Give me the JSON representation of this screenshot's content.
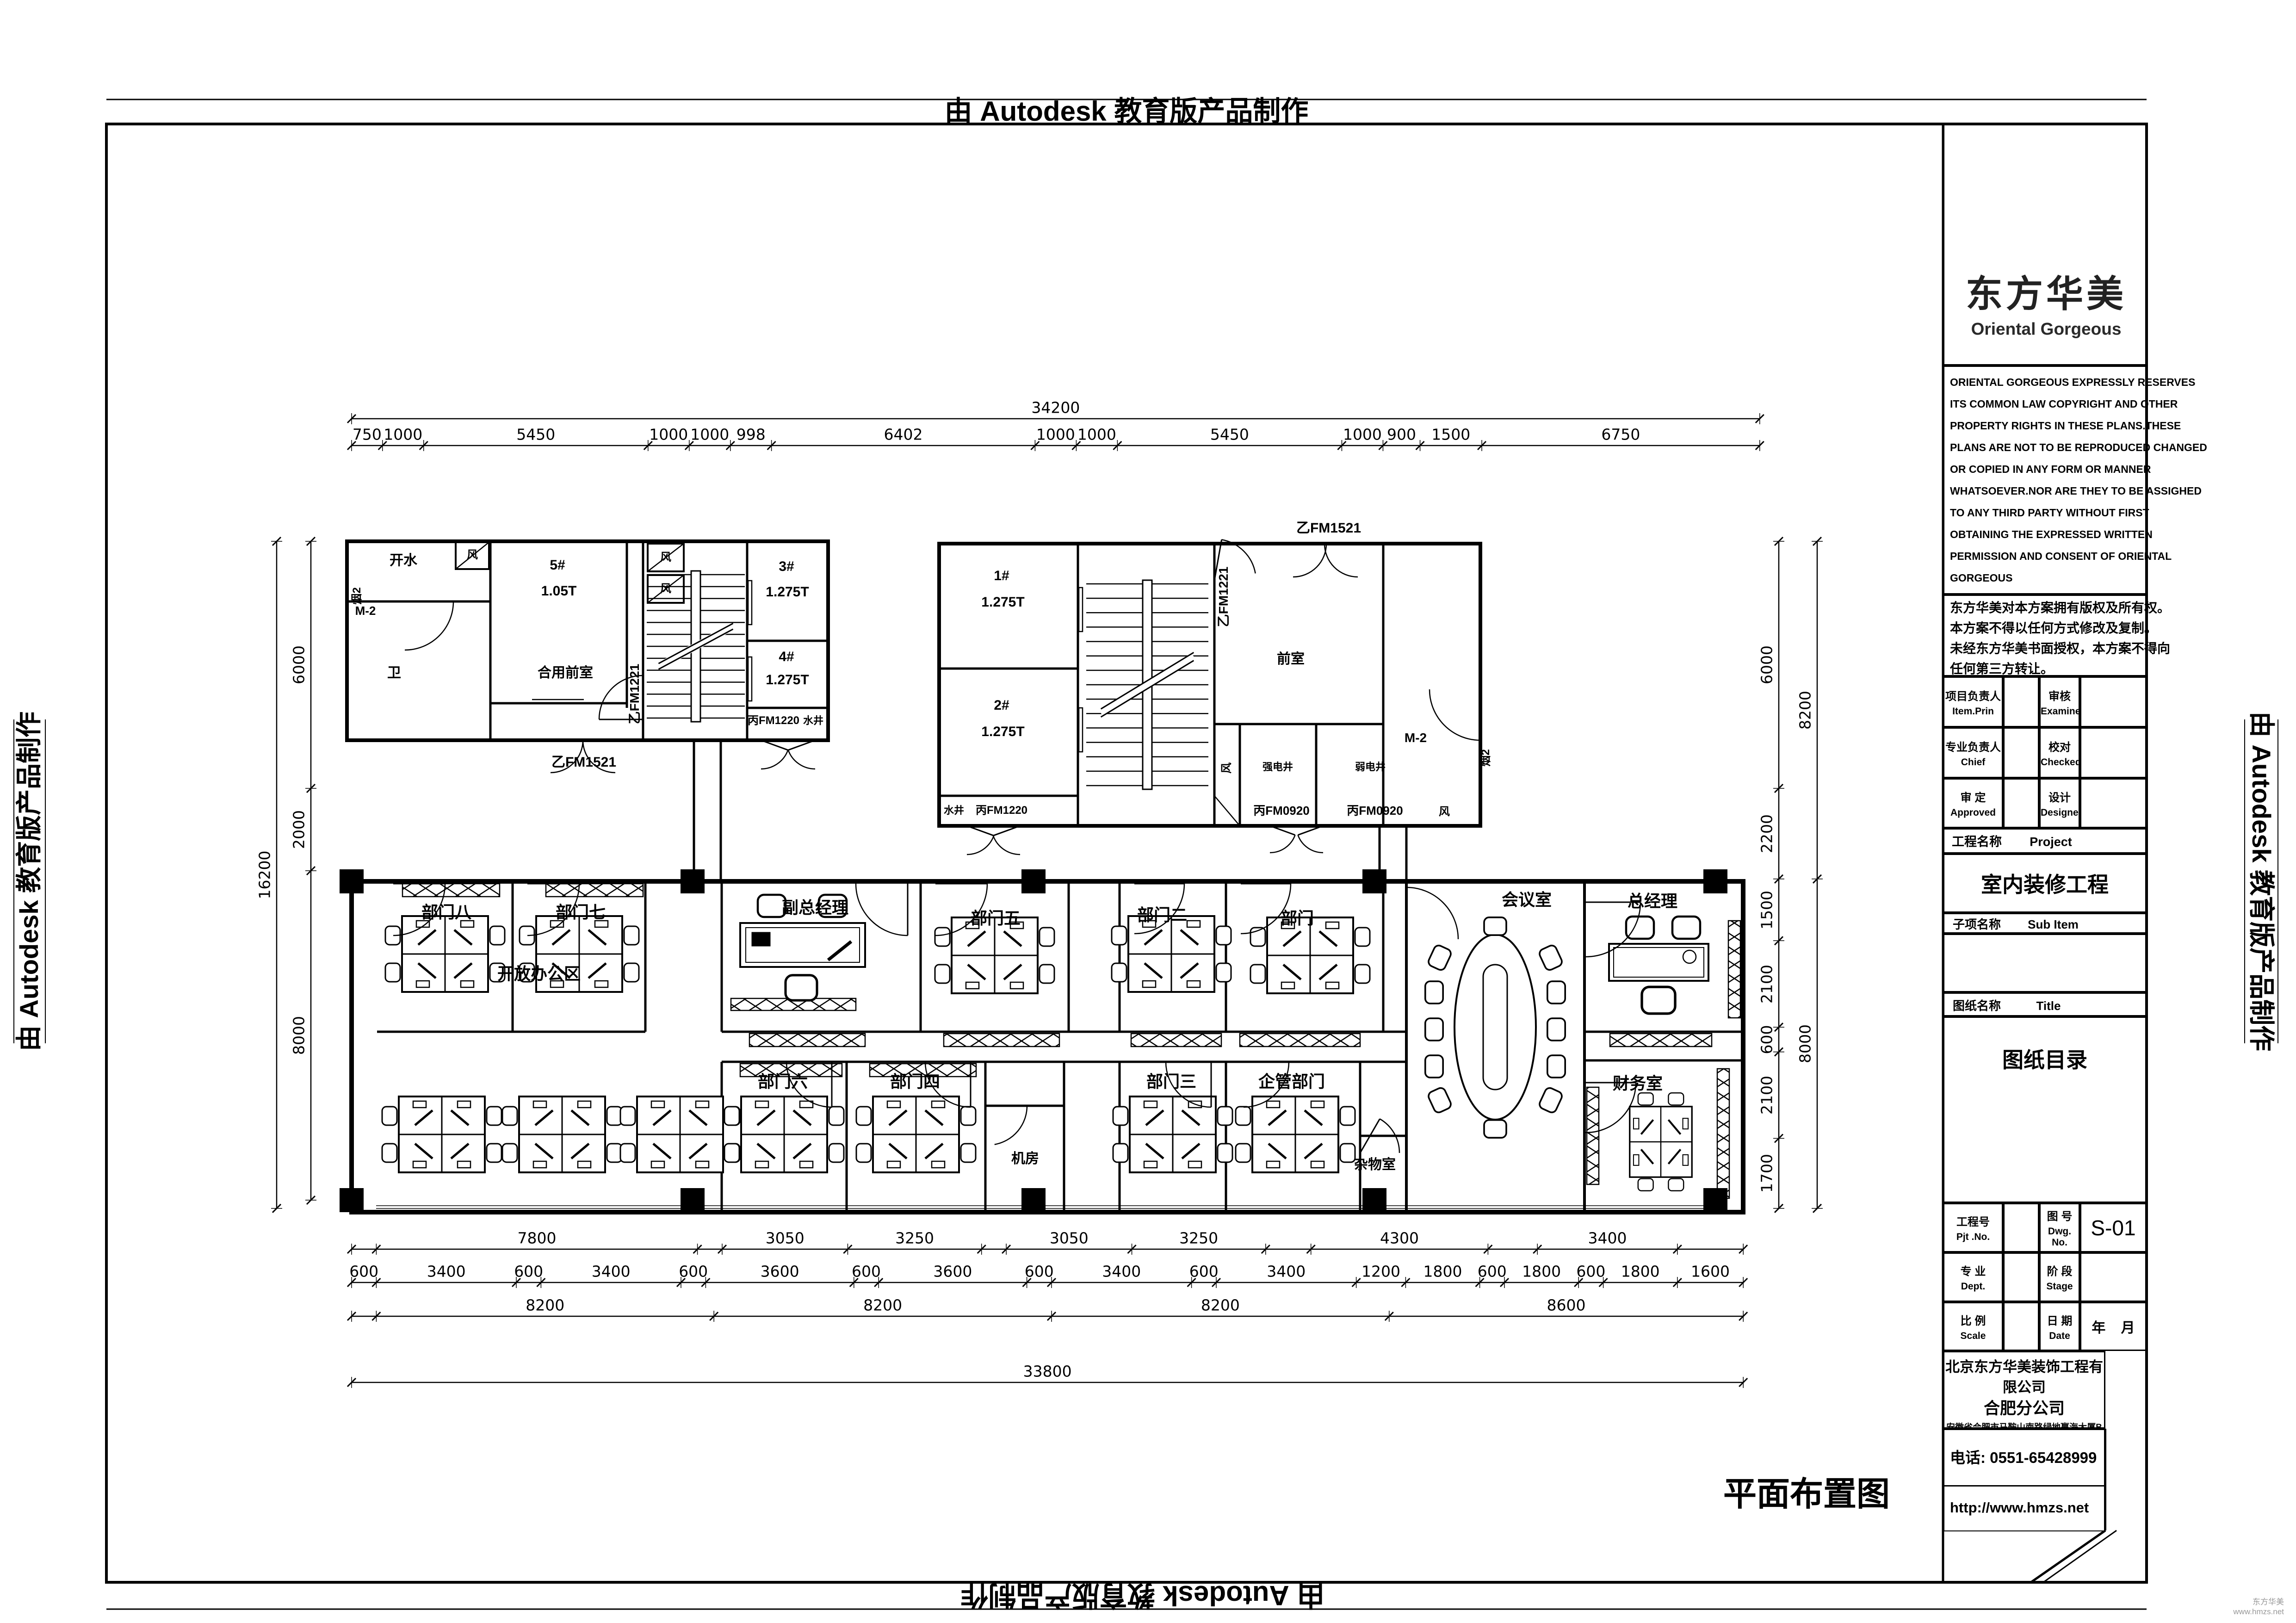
{
  "stamp": {
    "text": "由 Autodesk 教育版产品制作"
  },
  "sheet_title": "平面布置图",
  "watermark": {
    "line1": "东方华美",
    "line2": "www.hmzs.net"
  },
  "dims": {
    "top_total": "34200",
    "top": [
      "750",
      "1000",
      "5450",
      "1000",
      "1000",
      "998",
      "6402",
      "1000",
      "1000",
      "5450",
      "1000",
      "900",
      "1500",
      "6750"
    ],
    "left_total": "16200",
    "left": [
      "6000",
      "2000",
      "8000"
    ],
    "right_inner": [
      "6000",
      "2200",
      "1500",
      "2100",
      "600",
      "2100",
      "1700"
    ],
    "right_outer": [
      "8200",
      "8000"
    ],
    "bottom_row1": [
      "7800",
      "3050",
      "3250",
      "3050",
      "3250",
      "4300",
      "3400"
    ],
    "bottom_row2": [
      "600",
      "3400",
      "600",
      "3400",
      "600",
      "3600",
      "600",
      "3600",
      "600",
      "3400",
      "600",
      "3400",
      "1200",
      "1800",
      "600",
      "1800",
      "600",
      "1800",
      "1600"
    ],
    "bottom_row3": [
      "8200",
      "8200",
      "8200",
      "8600"
    ],
    "bottom_total": "33800"
  },
  "core_left": {
    "hot_water": "开水",
    "flue": "烟2",
    "m2": "M-2",
    "wc": "卫",
    "lift5": "5#",
    "lift5_cap": "1.05T",
    "lobby": "合用前室",
    "door_a": "乙FM1221",
    "door_b": "乙FM1521",
    "door_c": "丙FM1220",
    "water_well": "水井",
    "lift3": "3#",
    "lift3_cap": "1.275T",
    "lift4": "4#",
    "lift4_cap": "1.275T",
    "vent": "风"
  },
  "core_right": {
    "lift1": "1#",
    "lift1_cap": "1.275T",
    "lift2": "2#",
    "lift2_cap": "1.275T",
    "lobby": "前室",
    "door_a": "乙FM1221",
    "door_b": "乙FM1521",
    "door_c": "丙FM1220",
    "door_d": "丙FM0920",
    "water_well": "水井",
    "strong_elec": "强电井",
    "weak_elec": "弱电井",
    "vent": "风",
    "m2": "M-2",
    "flue": "烟2"
  },
  "rooms": {
    "dept8": "部门八",
    "dept7": "部门七",
    "deputy_gm": "副总经理",
    "dept5": "部门五",
    "dept2": "部门二",
    "dept1": "部门一",
    "meeting": "会议室",
    "gm": "总经理",
    "open_office": "开放办公区",
    "dept6": "部门六",
    "dept4": "部门四",
    "server": "机房",
    "dept3": "部门三",
    "mgmt": "企管部门",
    "storage": "杂物室",
    "finance": "财务室"
  },
  "title_block": {
    "logo_cn": "东方华美",
    "logo_en": "Oriental  Gorgeous",
    "copyright_en": [
      "ORIENTAL GORGEOUS EXPRESSLY RESERVES",
      "ITS COMMON LAW COPYRIGHT AND OTHER",
      "PROPERTY RIGHTS IN THESE PLANS.THESE",
      "PLANS ARE NOT TO BE REPRODUCED CHANGED",
      "OR COPIED IN ANY FORM OR MANNER",
      "WHATSOEVER.NOR ARE THEY TO BE ASSIGHED",
      "TO ANY THIRD PARTY WITHOUT FIRST",
      "OBTAINING THE EXPRESSED WRITTEN",
      "PERMISSION AND CONSENT OF ORIENTAL",
      "GORGEOUS"
    ],
    "copyright_cn": [
      "东方华美对本方案拥有版权及所有权。",
      "本方案不得以任何方式修改及复制。",
      "未经东方华美书面授权，本方案不得向",
      "任何第三方转让。"
    ],
    "personnel": {
      "item_prin_cn": "项目负责人",
      "item_prin_en": "Item.Prin",
      "examined_cn": "审核",
      "examined_en": "Examined",
      "chief_cn": "专业负责人",
      "chief_en": "Chief",
      "checked_cn": "校对",
      "checked_en": "Checked",
      "approved_cn": "审 定",
      "approved_en": "Approved",
      "designed_cn": "设计",
      "designed_en": "Designed"
    },
    "project_label_cn": "工程名称",
    "project_label_en": "Project",
    "project_name": "室内装修工程",
    "subitem_label_cn": "子项名称",
    "subitem_label_en": "Sub Item",
    "title_label_cn": "图纸名称",
    "title_label_en": "Title",
    "drawing_title": "图纸目录",
    "pjt_cn": "工程号",
    "pjt_en": "Pjt .No.",
    "dwg_cn": "图 号",
    "dwg_en": "Dwg. No.",
    "dwg_no": "S-01",
    "dept_cn": "专 业",
    "dept_en": "Dept.",
    "stage_cn": "阶 段",
    "stage_en": "Stage",
    "scale_cn": "比 例",
    "scale_en": "Scale",
    "date_cn": "日 期",
    "date_en": "Date",
    "date_value": "年    月",
    "company": "北京东方华美装饰工程有限公司",
    "branch": "合肥分公司",
    "address": "安徽省合肥市马鞍山南路绿地赢海大厦B座19楼",
    "phone": "电话: 0551-65428999",
    "website": "http://www.hmzs.net"
  }
}
